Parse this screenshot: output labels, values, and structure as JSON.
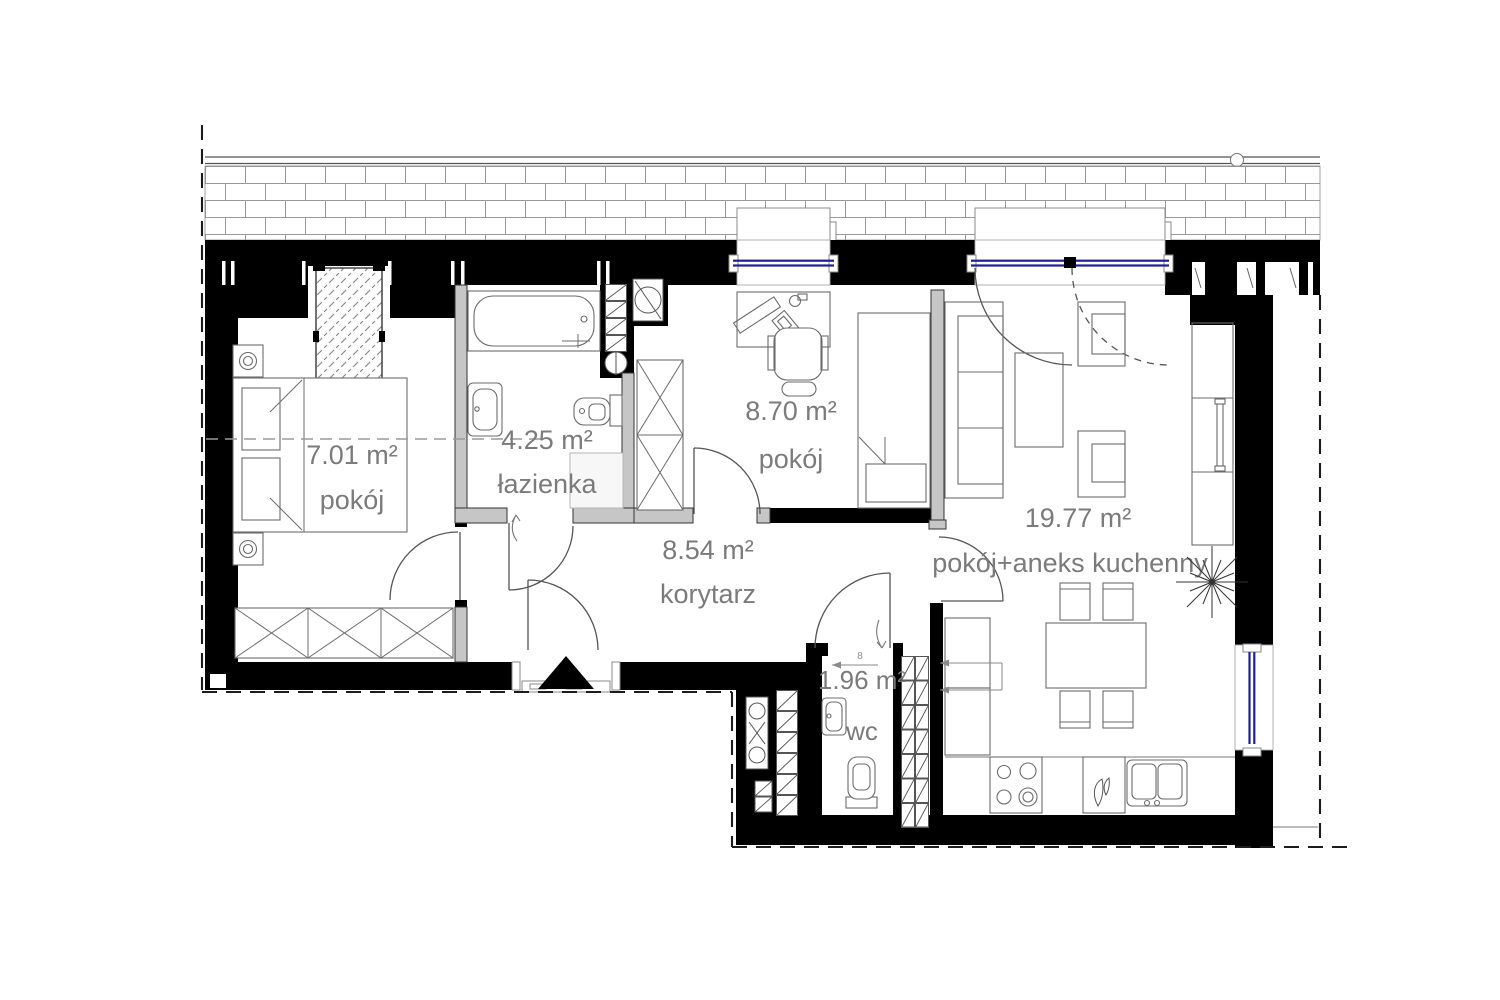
{
  "plan": {
    "type": "apartment-floor-plan",
    "colors": {
      "wall_fill": "#000000",
      "partition_fill": "#c6c6c6",
      "window_glass": "#1f1f9c",
      "label_text": "#7b7b7b",
      "brick_line": "#999999"
    },
    "rooms": [
      {
        "area": "7.01 m²",
        "name": "pokój"
      },
      {
        "area": "4.25 m²",
        "name": "łazienka"
      },
      {
        "area": "8.70 m²",
        "name": "pokój"
      },
      {
        "area": "8.54 m²",
        "name": "korytarz"
      },
      {
        "area": "19.77 m²",
        "name": "pokój+aneks kuchenny"
      },
      {
        "area": "1.96 m²",
        "name": "wc"
      }
    ],
    "annotations": {
      "door_width_mark": "8"
    },
    "fixtures": [
      "double-bed",
      "nightstand",
      "wardrobe",
      "hatched-cabinet",
      "bathtub",
      "washbasin",
      "toilet",
      "washing-machine",
      "shower-tray",
      "desk",
      "office-chair",
      "single-bed",
      "sofa",
      "coffee-table",
      "armchair",
      "tall-cabinet",
      "plant",
      "dining-table",
      "chair",
      "stove",
      "kitchen-sink",
      "wc-washbasin",
      "wc-toilet",
      "ventilation-shaft",
      "entrance-marker"
    ]
  }
}
